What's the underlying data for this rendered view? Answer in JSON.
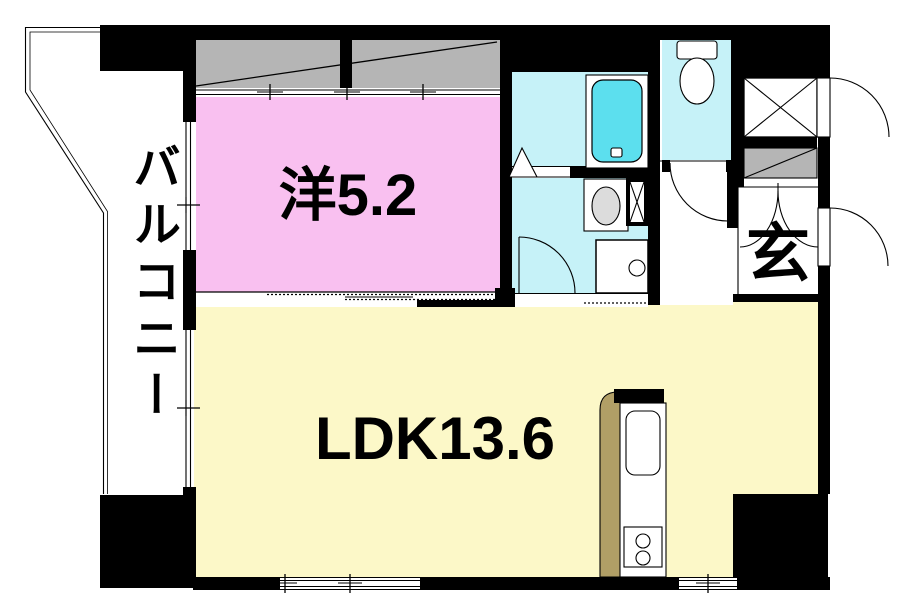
{
  "meta": {
    "type": "apartment-floor-plan"
  },
  "labels": {
    "balcony": "バルコニー",
    "western_room": "洋5.2",
    "ldk": "LDK13.6",
    "entrance": "玄"
  },
  "rooms": [
    {
      "label": "洋5.2",
      "floor_color_key": "western"
    },
    {
      "label": "LDK13.6",
      "floor_color_key": "ldk"
    },
    {
      "label": "バルコニー",
      "floor_color_key": "white"
    },
    {
      "label": "玄",
      "floor_color_key": "white"
    }
  ],
  "fixtures": [
    "bathtub",
    "toilet",
    "washbasin",
    "washing-machine-pan",
    "pipe-space",
    "kitchen-counter",
    "kitchen-sink",
    "gas-stove",
    "closet",
    "meter-box",
    "sliding-window",
    "hinged-door",
    "folding-bath-door"
  ],
  "colors": {
    "wall": "#000000",
    "western": "#F9C0F0",
    "ldk": "#FCF8C8",
    "wet": "#C6F2F8",
    "tub": "#5CDFEE",
    "gray": "#B5B5B5",
    "tan": "#B19F66",
    "basin": "#DCDCDC"
  }
}
